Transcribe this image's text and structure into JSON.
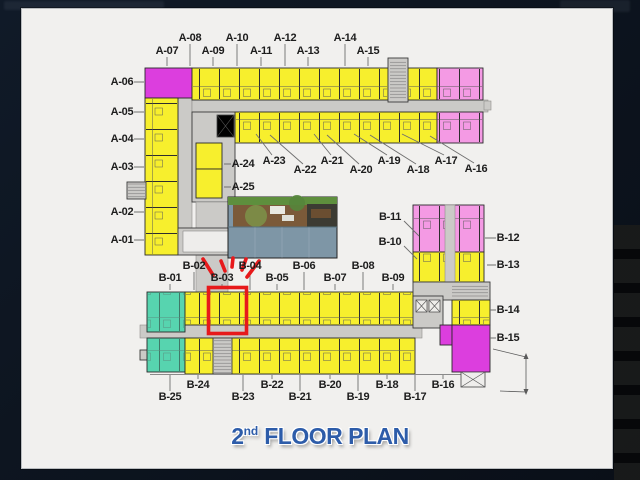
{
  "title": {
    "number": "2",
    "ordinal": "nd",
    "rest": "FLOOR PLAN"
  },
  "highlighted_unit": "B-03",
  "units": {
    "a_left": [
      "A-06",
      "A-05",
      "A-04",
      "A-03",
      "A-02",
      "A-01"
    ],
    "a_top": [
      "A-07",
      "A-08",
      "A-09",
      "A-10",
      "A-11",
      "A-12",
      "A-13",
      "A-14",
      "A-15"
    ],
    "a_core": [
      "A-24",
      "A-25"
    ],
    "a_bottom": [
      "A-23",
      "A-22",
      "A-21",
      "A-20",
      "A-19",
      "A-18",
      "A-17",
      "A-16"
    ],
    "b_top": [
      "B-01",
      "B-02",
      "B-03",
      "B-04",
      "B-05",
      "B-06",
      "B-07",
      "B-08",
      "B-09"
    ],
    "b_right": [
      "B-11",
      "B-10",
      "B-12",
      "B-13",
      "B-14",
      "B-15"
    ],
    "b_bottom": [
      "B-25",
      "B-24",
      "B-23",
      "B-22",
      "B-21",
      "B-20",
      "B-19",
      "B-18",
      "B-17",
      "B-16"
    ]
  },
  "colors": {
    "yellow": "#f7ef2d",
    "pink": "#f49ae4",
    "magenta": "#dc3ede",
    "teal": "#57d4af",
    "gray": "#cbcac7",
    "highlight": "#e7191b",
    "title_blue": "#2d5ca9",
    "label": "#1d1d1d"
  }
}
